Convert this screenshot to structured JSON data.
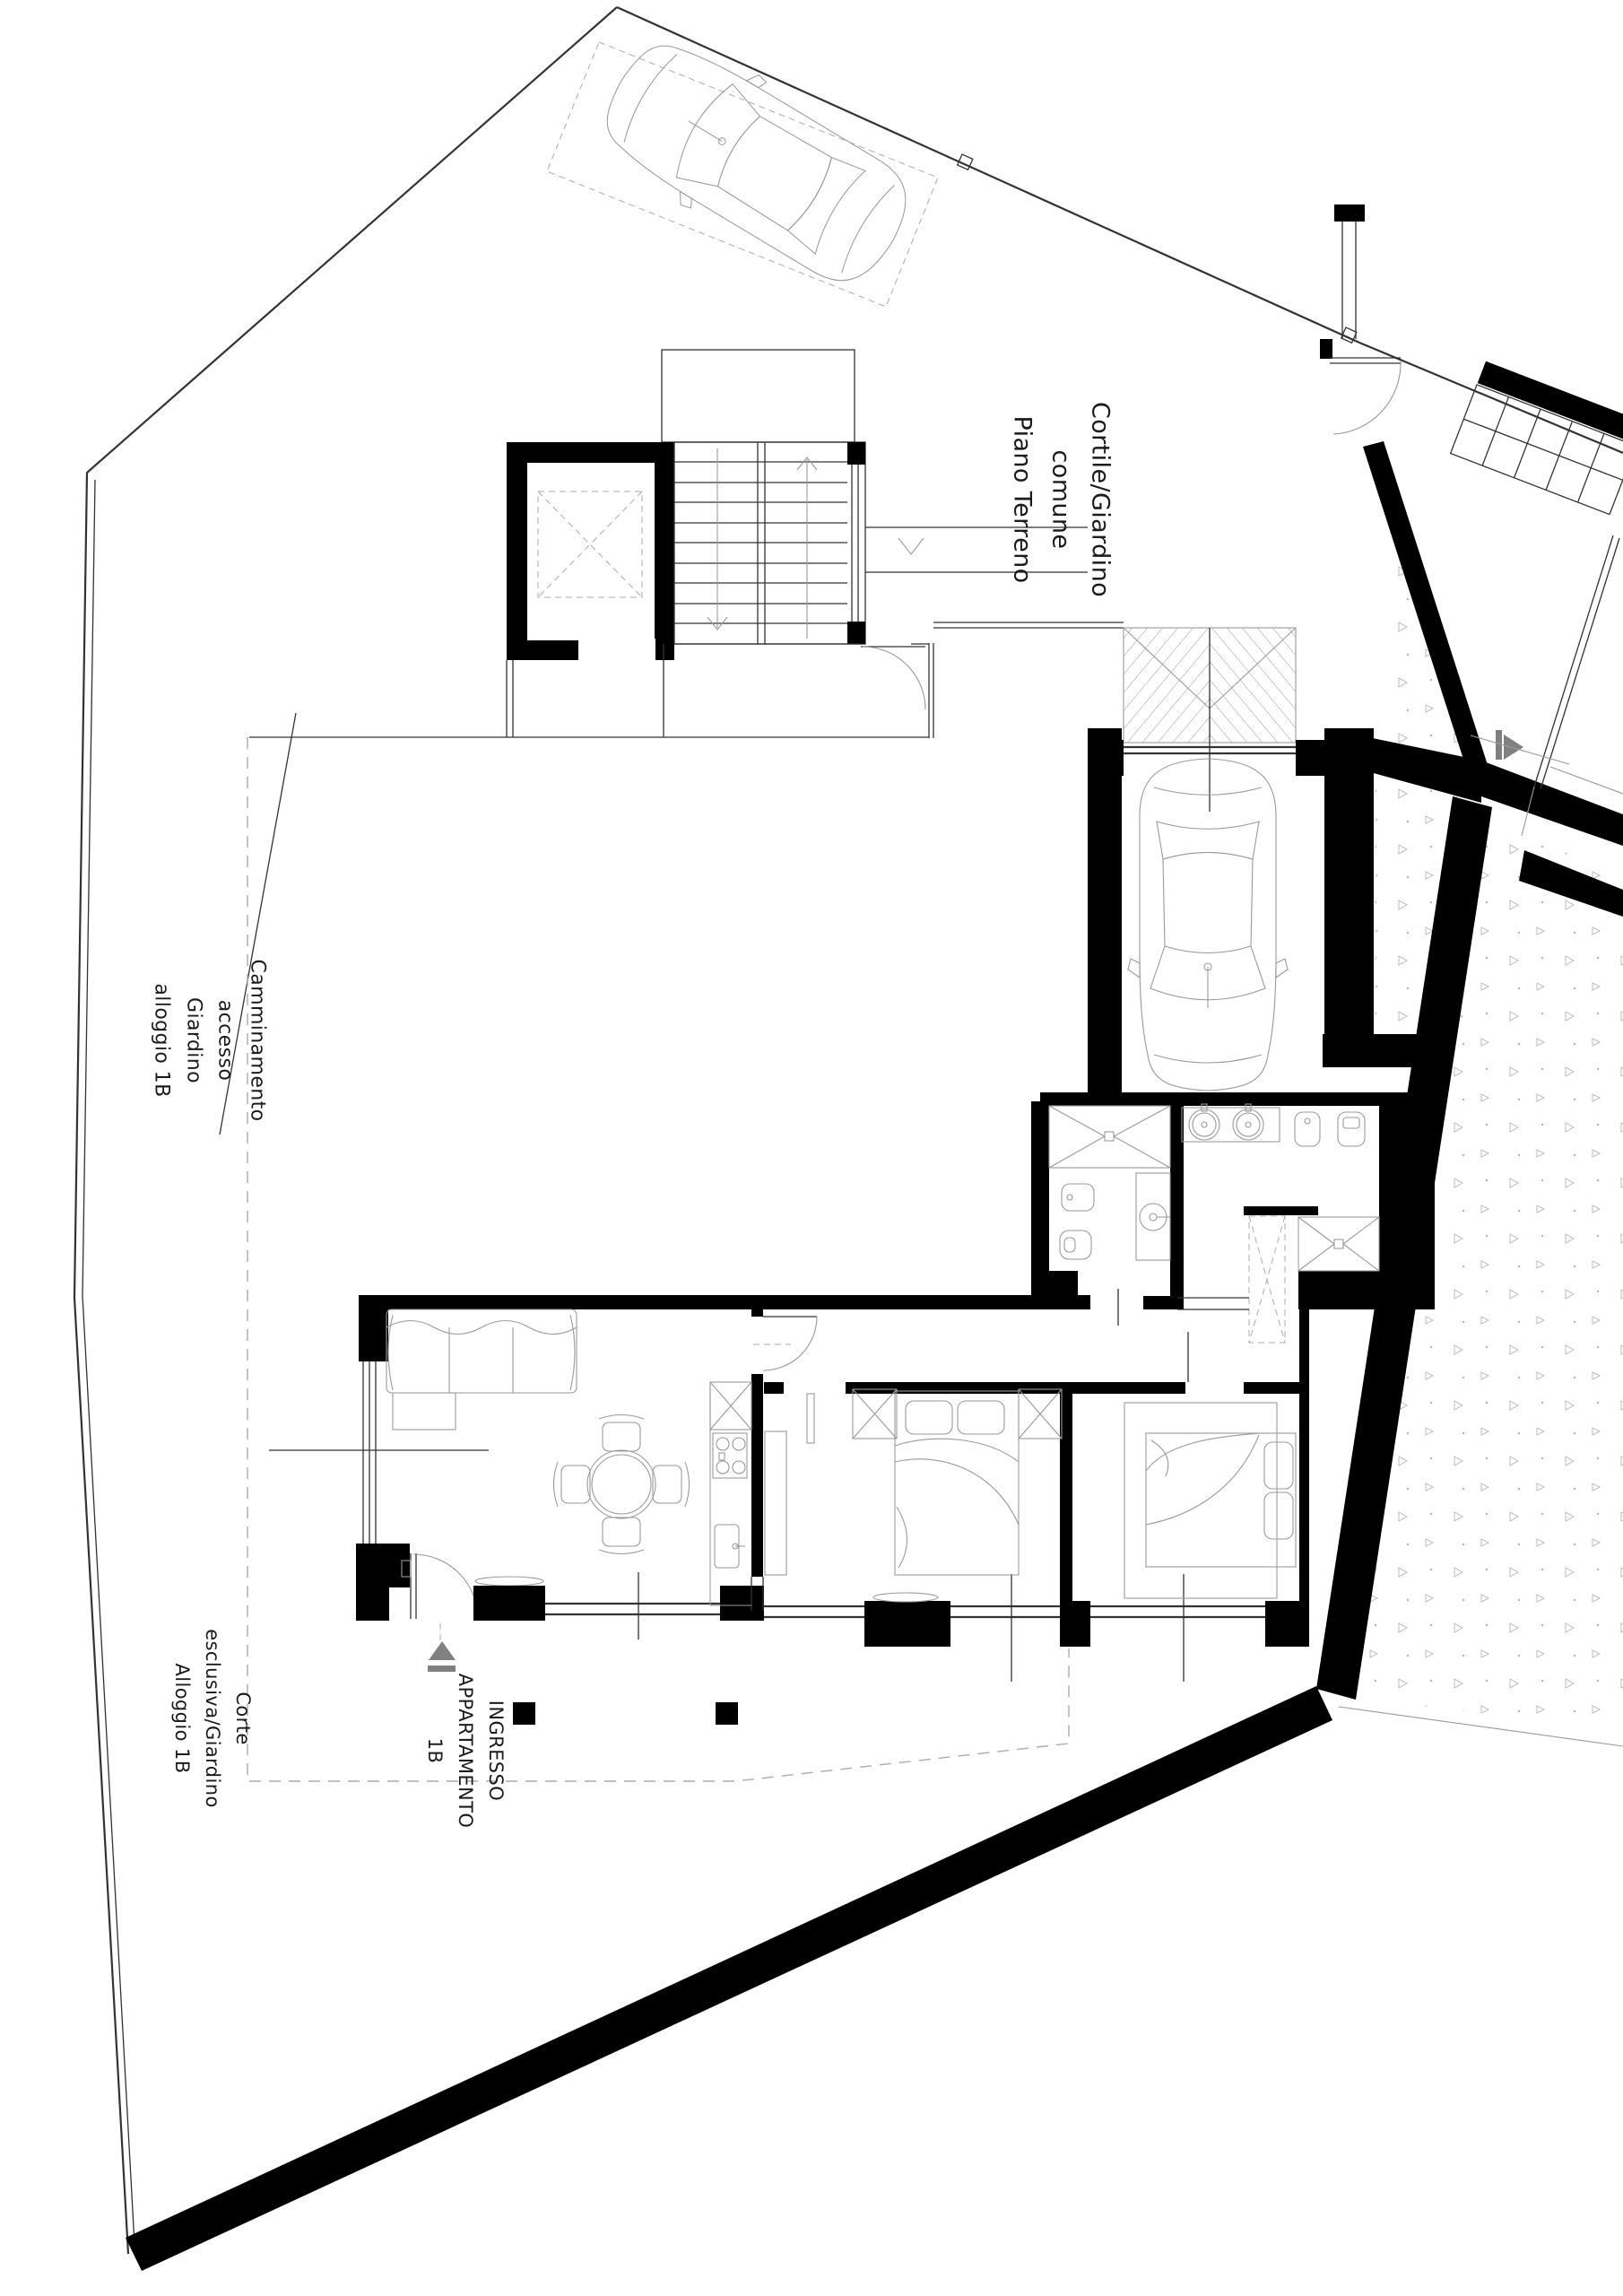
{
  "plan": {
    "type": "architectural-floor-plan",
    "floor": "Piano Terreno",
    "unit": "1B"
  },
  "labels": {
    "common_courtyard": {
      "text": "Cortile/Giardino\ncomune\nPiano Terreno"
    },
    "walkway": {
      "text": "Camminamento accesso\nGiardino alloggio 1B"
    },
    "private_courtyard": {
      "text": "Corte esclusiva/Giardino\nAlloggio 1B"
    },
    "apartment_entrance": {
      "text": "INGRESSO\nAPPARTAMENTO 1B"
    }
  },
  "colors": {
    "paper": "#ffffff",
    "wall": "#000000",
    "ink": "#333333",
    "lite": "#9a9a9a",
    "dash": "#ababab",
    "arrow": "#808080",
    "stip": "#b5b5b5"
  }
}
